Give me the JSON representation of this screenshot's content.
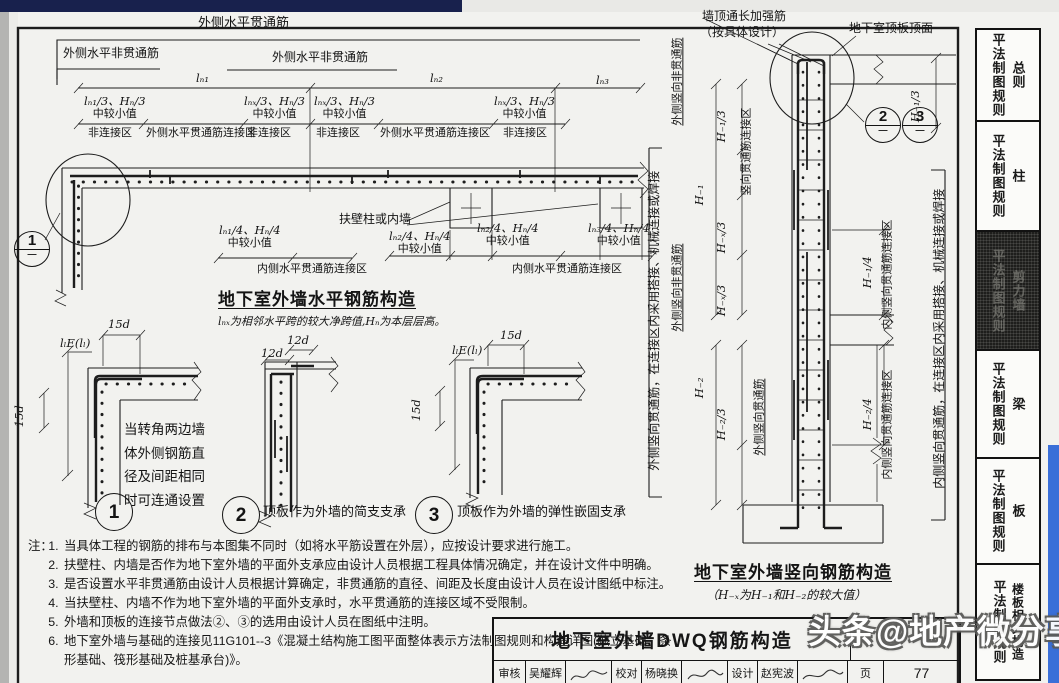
{
  "plan": {
    "bracket_label": "外侧水平贯通筋",
    "nonthrough1": "外侧水平非贯通筋",
    "nonthrough2": "外侧水平非贯通筋",
    "span1": "lₙ₁",
    "span2": "lₙ₂",
    "span3": "lₙ₃",
    "dims_top": [
      {
        "v": "lₙ₁/3、Hₙ/3",
        "note": "中较小值"
      },
      {
        "v": "lₙₓ/3、Hₙ/3",
        "note": "中较小值"
      },
      {
        "v": "lₙₓ/3、Hₙ/3",
        "note": "中较小值"
      },
      {
        "v": "lₙₓ/3、Hₙ/3",
        "note": "中较小值"
      }
    ],
    "zones": [
      "非连接区",
      "外侧水平贯通筋连接区",
      "非连接区",
      "非连接区",
      "外侧水平贯通筋连接区",
      "非连接区"
    ],
    "pilaster_label": "扶壁柱或内墙",
    "dims_bottom": [
      {
        "v": "lₙ₁/4、Hₙ/4",
        "note": "中较小值"
      },
      {
        "v": "lₙ₂/4、Hₙ/4",
        "note": "中较小值"
      },
      {
        "v": "lₙ₂/4、Hₙ/4",
        "note": "中较小值"
      },
      {
        "v": "lₙ₃/4、Hₙ/4",
        "note": "中较小值"
      }
    ],
    "zones_bottom": [
      "内侧水平贯通筋连接区",
      "内侧水平贯通筋连接区"
    ],
    "detail_bubble": {
      "top": "1",
      "bottom": "—"
    },
    "title": "地下室外墙水平钢筋构造",
    "subtitle": "lₙₓ为相邻水平跨的较大净跨值,Hₙ为本层层高。"
  },
  "details": {
    "d1": {
      "dim_top": "15d",
      "dim_lap": "lₗE(lₗ)",
      "dim_side": "15d",
      "note": "当转角两边墙体外侧钢筋直径及间距相同时可连通设置",
      "bubble": "1"
    },
    "d2": {
      "dim_a": "12d",
      "dim_b": "12d",
      "bubble": "2",
      "caption": "顶板作为外墙的简支支承"
    },
    "d3": {
      "dim_top": "15d",
      "dim_lap": "lₗE(lₗ)",
      "dim_side": "15d",
      "bubble": "3",
      "caption": "顶板作为外墙的弹性嵌固支承"
    }
  },
  "notes": {
    "prefix": "注：",
    "items": [
      "当具体工程的钢筋的排布与本图集不同时（如将水平筋设置在外层），应按设计要求进行施工。",
      "扶壁柱、内墙是否作为地下室外墙的平面外支承应由设计人员根据工程具体情况确定，并在设计文件中明确。",
      "是否设置水平非贯通筋由设计人员根据计算确定，非贯通筋的直径、间距及长度由设计人员在设计图纸中标注。",
      "当扶壁柱、内墙不作为地下室外墙的平面外支承时，水平贯通筋的连接区域不受限制。",
      "外墙和顶板的连接节点做法②、③的选用由设计人员在图纸中注明。",
      "地下室外墙与基础的连接见11G101--3《混凝土结构施工图平面整体表示方法制图规则和构造详图(独立基础、条形基础、筏形基础及桩基承台)》。"
    ]
  },
  "section": {
    "top_note_1a": "墙顶通长加强筋",
    "top_note_1b": "（按具体设计）",
    "top_note_2": "地下室顶板顶面",
    "bubble2": {
      "top": "2",
      "bottom": "—"
    },
    "bubble3": {
      "top": "3",
      "bottom": "—"
    },
    "left_bracket": "外侧竖向贯通筋，在连接区内采用搭接、机械连接或焊接",
    "right_bracket": "内侧竖向贯通筋，在连接区内采用搭接、机械连接或焊接",
    "outer_nonthrough_1": "外侧竖向非贯通筋",
    "outer_nonthrough_2": "外侧竖向非贯通筋",
    "outer_through": "外侧竖向贯通筋",
    "zone_left": "竖向贯通筋连接区",
    "zone_right_1": "内侧竖向贯通筋连接区",
    "zone_right_2": "内侧竖向贯通筋连接区",
    "dim_h1": "H₋₁",
    "dim_h2": "H₋₂",
    "dim_h1_3_left": "H₋₁/3",
    "dim_h1_3_right": "H₋₁/3",
    "dim_hx3_a": "H₋ₓ/3",
    "dim_hx3_b": "H₋ₓ/3",
    "dim_h2_3": "H₋₂/3",
    "dim_h1_4": "H₋₁/4",
    "dim_h2_4": "H₋₂/4",
    "title": "地下室外墙竖向钢筋构造",
    "subtitle": "（H₋ₓ为H₋₁和H₋₂的较大值）"
  },
  "title_block": {
    "title": "地下室外墙DWQ钢筋构造",
    "cells": [
      {
        "label": "审核",
        "name": "吴耀辉"
      },
      {
        "label": "校对",
        "name": "杨晓换"
      },
      {
        "label": "设计",
        "name": "赵宪波"
      }
    ],
    "page_label": "页",
    "page_number": "77"
  },
  "sidebar": {
    "tabs": [
      {
        "label": "平法制图规则",
        "sublabel": "总则"
      },
      {
        "label": "平法制图规则",
        "sublabel": "柱"
      },
      {
        "label": "平法制图规则",
        "sublabel": "剪力墙"
      },
      {
        "label": "平法制图规则",
        "sublabel": "梁"
      },
      {
        "label": "平法制图规则",
        "sublab el": "",
        "sublabel": "板"
      },
      {
        "label": "平法制图规则",
        "sublabel": "楼板相关构造"
      }
    ]
  },
  "watermark": {
    "text": "头条@地产微分享"
  },
  "colors": {
    "top_bar": "#18214d",
    "right_strip": "#3a6fd8",
    "ink": "#1d1d1d",
    "paper": "#fbfbf9"
  }
}
